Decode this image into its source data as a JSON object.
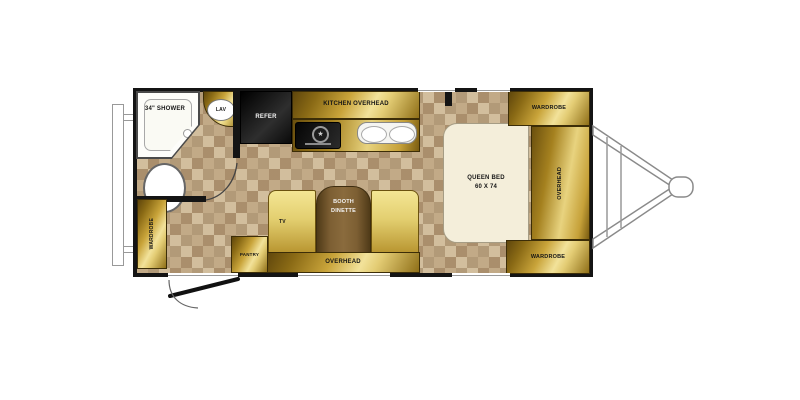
{
  "plan": {
    "type": "travel-trailer-floorplan",
    "labels": {
      "shower": "34\" SHOWER",
      "lav": "LAV",
      "refer": "REFER",
      "kitchen_overhead": "KITCHEN OVERHEAD",
      "wardrobe_front_top": "WARDROBE",
      "overhead_front": "OVERHEAD",
      "wardrobe_front_bottom": "WARDROBE",
      "wardrobe_rear": "WARDROBE",
      "pantry": "PANTRY",
      "tv": "TV",
      "overhead_dinette": "OVERHEAD",
      "queen_bed_line1": "QUEEN BED",
      "queen_bed_line2": "60 X 74",
      "dinette_line1": "BOOTH",
      "dinette_line2": "DINETTE"
    },
    "colors": {
      "wall": "#141414",
      "floor_light": "#c9b28e",
      "floor_dark": "#a98e6b",
      "cabinet_gold_dark": "#6e520f",
      "cabinet_gold_light": "#f2e29a",
      "bed_fill": "#f4eeda",
      "dinette_table": "#7d5f33",
      "bench_gold": "#e9d678",
      "fixture_white": "#ffffff"
    }
  }
}
